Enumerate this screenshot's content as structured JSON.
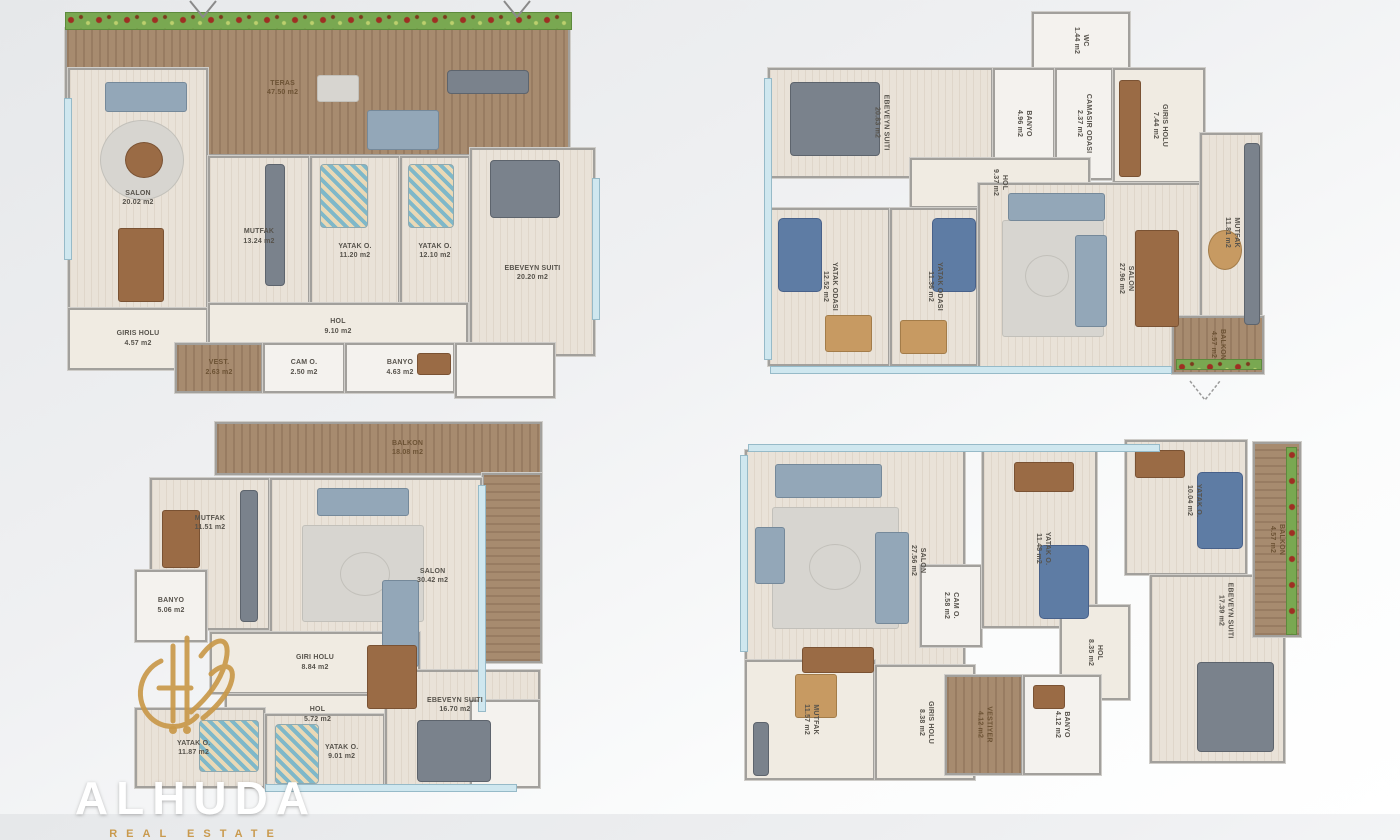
{
  "palette": {
    "deck_wood": "#a78b6f",
    "flower_green": "#79a851",
    "flower_red": "#9e2f23",
    "floor": "#e9e2d8",
    "wall_gray": "#a2a09c",
    "window_blue": "#cfe7ef",
    "furniture_blue": "#5e7ca4",
    "logo_gold": "#c99a4e"
  },
  "logo": {
    "title": "ALHUDA",
    "subtitle": "REAL ESTATE"
  },
  "plans": {
    "plan1": {
      "rooms": {
        "teras": {
          "label": "TERAS",
          "area": "47.50 m2"
        },
        "salon": {
          "label": "SALON",
          "area": "20.02 m2"
        },
        "mutfak": {
          "label": "MUTFAK",
          "area": "13.24 m2"
        },
        "yatak1": {
          "label": "YATAK O.",
          "area": "11.20 m2"
        },
        "yatak2": {
          "label": "YATAK O.",
          "area": "12.10 m2"
        },
        "ebeveyn": {
          "label": "EBEVEYN SUITI",
          "area": "20.20 m2"
        },
        "giris": {
          "label": "GIRIS HOLU",
          "area": "4.57 m2"
        },
        "hol": {
          "label": "HOL",
          "area": "9.10 m2"
        },
        "vest": {
          "label": "VEST.",
          "area": "2.63 m2"
        },
        "cam": {
          "label": "CAM O.",
          "area": "2.50 m2"
        },
        "banyo": {
          "label": "BANYO",
          "area": "4.63 m2"
        }
      }
    },
    "plan2": {
      "rooms": {
        "ebeveyn": {
          "label": "EBEVEYN SUITI",
          "area": "20.83 m2"
        },
        "banyo": {
          "label": "BANYO",
          "area": "4.96 m2"
        },
        "camasir": {
          "label": "CAMASIR ODASI",
          "area": "2.37 m2"
        },
        "wc": {
          "label": "WC",
          "area": "1.44 m2"
        },
        "giris": {
          "label": "GIRIS HOLU",
          "area": "7.44 m2"
        },
        "hol": {
          "label": "HOL",
          "area": "9.37 m2"
        },
        "yatak1": {
          "label": "YATAK ODASI",
          "area": "12.52 m2"
        },
        "yatak2": {
          "label": "YATAK ODASI",
          "area": "11.36 m2"
        },
        "salon": {
          "label": "SALON",
          "area": "27.96 m2"
        },
        "mutfak": {
          "label": "MUTFAK",
          "area": "11.81 m2"
        },
        "balkon": {
          "label": "BALKON",
          "area": "4.57 m2"
        }
      }
    },
    "plan3": {
      "rooms": {
        "balkon": {
          "label": "BALKON",
          "area": "18.08 m2"
        },
        "mutfak": {
          "label": "MUTFAK",
          "area": "11.51 m2"
        },
        "salon": {
          "label": "SALON",
          "area": "30.42 m2"
        },
        "banyo": {
          "label": "BANYO",
          "area": "5.06 m2"
        },
        "giris": {
          "label": "GIRI HOLU",
          "area": "8.84 m2"
        },
        "hol": {
          "label": "HOL",
          "area": "5.72 m2"
        },
        "yatak1": {
          "label": "YATAK O.",
          "area": "11.87 m2"
        },
        "yatak2": {
          "label": "YATAK O.",
          "area": "9.01 m2"
        },
        "ebeveyn": {
          "label": "EBEVEYN SUITI",
          "area": "16.70 m2"
        }
      }
    },
    "plan4": {
      "rooms": {
        "salon": {
          "label": "SALON",
          "area": "27.56 m2"
        },
        "cam": {
          "label": "CAM O.",
          "area": "2.58 m2"
        },
        "yatak1": {
          "label": "YATAK O.",
          "area": "11.48 m2"
        },
        "yatak2": {
          "label": "YATAK O.",
          "area": "10.04 m2"
        },
        "ebeveyn": {
          "label": "EBEVEYN SUITI",
          "area": "17.39 m2"
        },
        "hol": {
          "label": "HOL",
          "area": "8.35 m2"
        },
        "mutfak": {
          "label": "MUTFAK",
          "area": "11.57 m2"
        },
        "giris": {
          "label": "GIRIS HOLU",
          "area": "8.38 m2"
        },
        "vestiyer": {
          "label": "VESTIYER",
          "area": "4.12 m2"
        },
        "banyo": {
          "label": "BANYO",
          "area": "4.12 m2"
        },
        "balkon": {
          "label": "BALKON",
          "area": "4.57 m2"
        }
      }
    }
  }
}
